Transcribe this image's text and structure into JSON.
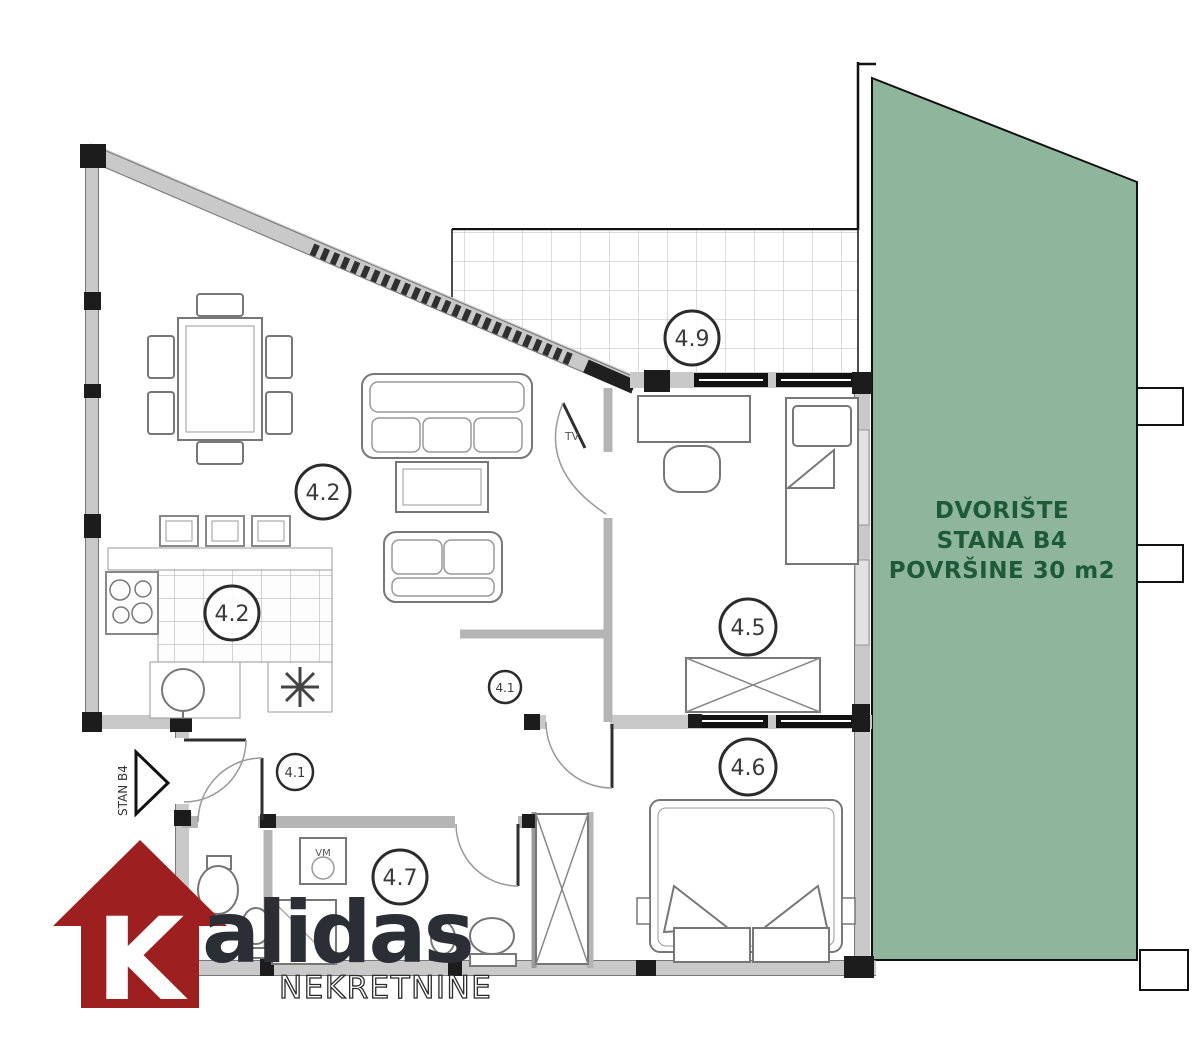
{
  "yard": {
    "line1": "DVORIŠTE",
    "line2": "STANA B4",
    "line3": "POVRŠINE 30 m2",
    "fill": "#8FB69D",
    "text_color": "#1D5B38"
  },
  "rooms": {
    "living": "4.2",
    "kitchen": "4.2",
    "hall": "4.1",
    "corridor": "4.1",
    "bedroom1": "4.5",
    "bedroom2": "4.6",
    "bathroom": "4.7",
    "terrace": "4.9"
  },
  "annotations": {
    "tv": "TV",
    "vm": "VM",
    "entrance_label": "STAN B4"
  },
  "logo": {
    "initial": "K",
    "name": "alidas",
    "subtitle": "NEKRETNINE",
    "house_color": "#9E1F1F",
    "name_color": "#2B2E35"
  }
}
